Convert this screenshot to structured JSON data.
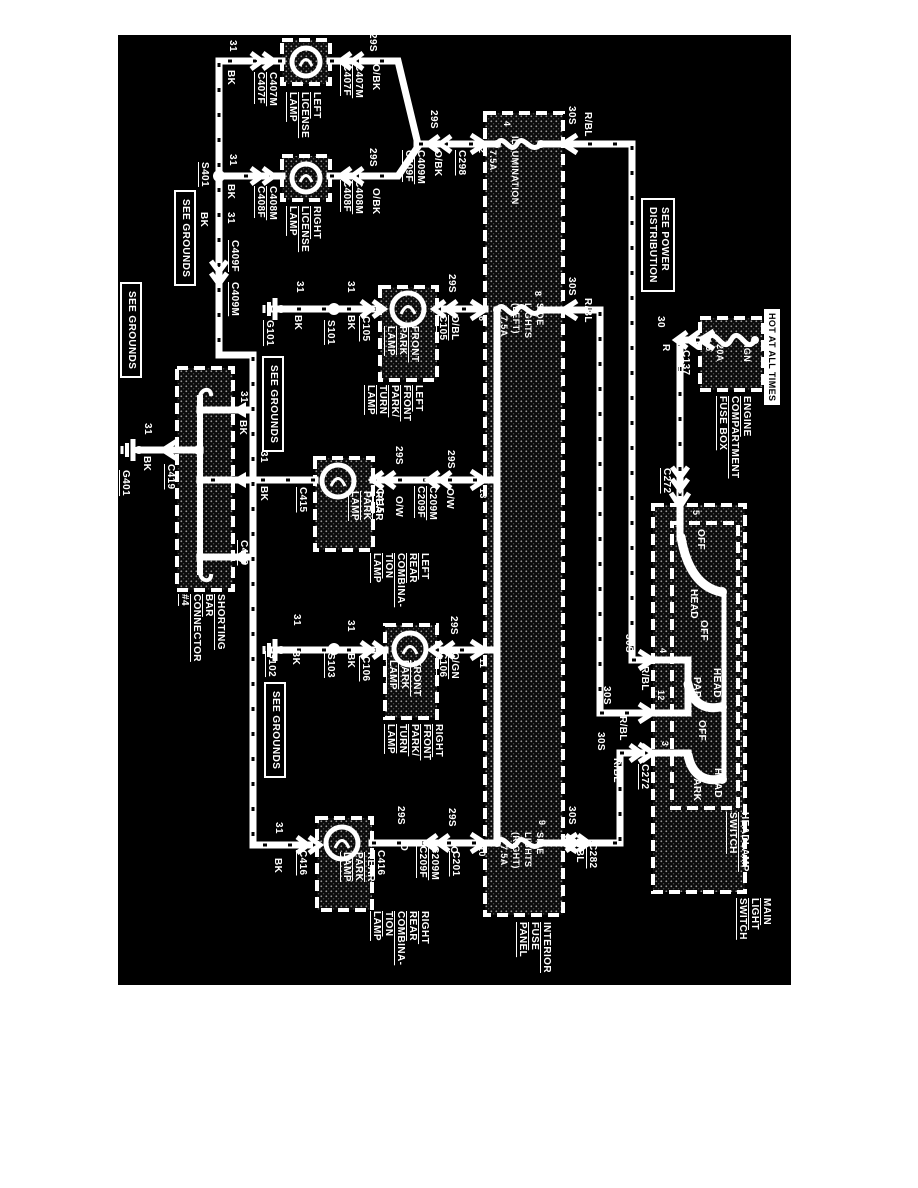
{
  "page": {
    "type": "wiring-diagram",
    "colors": {
      "page_bg": "#ffffff",
      "diagram_bg": "#000000",
      "line": "#ffffff"
    }
  },
  "diagram": {
    "labels": [
      {
        "i": "wire-31-left-license",
        "t": "31",
        "x": 226,
        "y": 40
      },
      {
        "i": "wire-bk-left-license",
        "t": "BK",
        "x": 224,
        "y": 70
      },
      {
        "i": "conn-c407-pair-left",
        "t": "C407M\nC407F",
        "x": 254,
        "y": 72,
        "u": 1
      },
      {
        "i": "left-license-lamp-label",
        "t": "LEFT\nLICENSE\nLAMP",
        "x": 286,
        "y": 92,
        "u": 1
      },
      {
        "i": "conn-c407-pair-right",
        "t": "C407M\nC407F",
        "x": 340,
        "y": 64,
        "u": 1
      },
      {
        "i": "wire-29s-left-license",
        "t": "29S",
        "x": 366,
        "y": 33
      },
      {
        "i": "wire-obk-left-license",
        "t": "O/BK",
        "x": 369,
        "y": 64
      },
      {
        "i": "splice-s401-label",
        "t": "S401",
        "x": 198,
        "y": 162,
        "u": 1
      },
      {
        "i": "wire-31-right-license",
        "t": "31",
        "x": 226,
        "y": 154
      },
      {
        "i": "wire-bk-right-license",
        "t": "BK",
        "x": 224,
        "y": 184
      },
      {
        "i": "conn-c408-pair-left",
        "t": "C408M\nC408F",
        "x": 254,
        "y": 186,
        "u": 1
      },
      {
        "i": "right-license-lamp-label",
        "t": "RIGHT\nLICENSE\nLAMP",
        "x": 286,
        "y": 206,
        "u": 1
      },
      {
        "i": "conn-c408-pair-right",
        "t": "C408M\nC408F",
        "x": 340,
        "y": 180,
        "u": 1
      },
      {
        "i": "wire-29s-right-license",
        "t": "29S",
        "x": 366,
        "y": 148
      },
      {
        "i": "wire-obk-right-license",
        "t": "O/BK",
        "x": 369,
        "y": 188
      },
      {
        "i": "wire-29s-merge",
        "t": "29S",
        "x": 427,
        "y": 110
      },
      {
        "i": "conn-c409-pair-merge",
        "t": "C409M\nC409F",
        "x": 402,
        "y": 150,
        "u": 1
      },
      {
        "i": "wire-obk-merge",
        "t": "O/BK",
        "x": 431,
        "y": 150
      },
      {
        "i": "conn-c298",
        "t": "C298",
        "x": 455,
        "y": 150,
        "u": 1
      },
      {
        "i": "wire-31-bus",
        "t": "31",
        "x": 224,
        "y": 212
      },
      {
        "i": "wire-bk-bus",
        "t": "BK",
        "x": 197,
        "y": 212
      },
      {
        "i": "conn-c409f-bus",
        "t": "C409F",
        "x": 228,
        "y": 240,
        "u": 1
      },
      {
        "i": "conn-c409m-bus",
        "t": "C409M",
        "x": 228,
        "y": 282,
        "u": 1
      },
      {
        "i": "see-grounds-1",
        "t": "SEE GROUNDS",
        "x": 174,
        "y": 190,
        "b": 1
      },
      {
        "i": "see-grounds-2",
        "t": "SEE GROUNDS",
        "x": 262,
        "y": 356,
        "b": 1
      },
      {
        "i": "see-grounds-3",
        "t": "SEE GROUNDS",
        "x": 120,
        "y": 282,
        "b": 1
      },
      {
        "i": "see-grounds-4",
        "t": "SEE GROUNDS",
        "x": 264,
        "y": 682,
        "b": 1
      },
      {
        "i": "wire-31-branch1",
        "t": "31",
        "x": 237,
        "y": 391
      },
      {
        "i": "wire-bk-branch1",
        "t": "BK",
        "x": 236,
        "y": 420
      },
      {
        "i": "wire-31-c415-gnd",
        "t": "31",
        "x": 257,
        "y": 451
      },
      {
        "i": "wire-bk-c415-gnd",
        "t": "BK",
        "x": 257,
        "y": 486
      },
      {
        "i": "conn-c419-entry",
        "t": "C419",
        "x": 237,
        "y": 540,
        "u": 1
      },
      {
        "i": "shorting-bar-label",
        "t": "SHORTING\nBAR\nCONNECTOR\n#4",
        "x": 178,
        "y": 594,
        "u": 1
      },
      {
        "i": "conn-c419-exit",
        "t": "C419",
        "x": 164,
        "y": 464,
        "u": 1
      },
      {
        "i": "wire-31-g401",
        "t": "31",
        "x": 141,
        "y": 423
      },
      {
        "i": "wire-bk-g401",
        "t": "BK",
        "x": 140,
        "y": 456
      },
      {
        "i": "ground-g401-label",
        "t": "G401",
        "x": 119,
        "y": 470,
        "u": 1
      },
      {
        "i": "ground-g101-label",
        "t": "G101",
        "x": 263,
        "y": 320,
        "u": 1
      },
      {
        "i": "wire-31-g101",
        "t": "31",
        "x": 293,
        "y": 281
      },
      {
        "i": "wire-bk-g101",
        "t": "BK",
        "x": 291,
        "y": 315
      },
      {
        "i": "splice-s101-label",
        "t": "S101",
        "x": 324,
        "y": 320,
        "u": 1
      },
      {
        "i": "wire-31-s101",
        "t": "31",
        "x": 344,
        "y": 281
      },
      {
        "i": "wire-bk-s101",
        "t": "BK",
        "x": 344,
        "y": 315
      },
      {
        "i": "conn-c105-left",
        "t": "C105",
        "x": 359,
        "y": 316,
        "u": 1
      },
      {
        "i": "front-park-lamp-1-label",
        "t": "FRONT\nPARK\nLAMP",
        "x": 384,
        "y": 326,
        "u": 1
      },
      {
        "i": "wire-29s-c105",
        "t": "29S",
        "x": 445,
        "y": 274
      },
      {
        "i": "conn-obl-c105",
        "t": "O/BL\nC105",
        "x": 436,
        "y": 315,
        "u": 1
      },
      {
        "i": "left-front-park-turn-label",
        "t": "LEFT\nFRONT\nPARK/\nTURN\nLAMP",
        "x": 364,
        "y": 385,
        "u": 1
      },
      {
        "i": "fp-pin-4",
        "t": "4",
        "x": 501,
        "y": 121,
        "f": 9
      },
      {
        "i": "fp-pin-2",
        "t": "2",
        "x": 476,
        "y": 148,
        "f": 9
      },
      {
        "i": "fuse-illumination",
        "t": "ILLUMINATION",
        "x": 509,
        "y": 136,
        "f": 9
      },
      {
        "i": "fuse-illumination-amp",
        "t": "7.5A",
        "x": 487,
        "y": 150,
        "f": 9
      },
      {
        "i": "fp-pin-8",
        "t": "8",
        "x": 532,
        "y": 291,
        "f": 9
      },
      {
        "i": "fp-pin-6",
        "t": "6",
        "x": 476,
        "y": 316,
        "f": 9
      },
      {
        "i": "fuse-side-lights-left",
        "t": "SIDE\nLIGHTS\n(LEFT)",
        "x": 510,
        "y": 303,
        "f": 9
      },
      {
        "i": "fuse-side-lights-left-amp",
        "t": "7.5A",
        "x": 498,
        "y": 316,
        "f": 9
      },
      {
        "i": "fp-pin-13",
        "t": "13",
        "x": 477,
        "y": 488,
        "f": 9
      },
      {
        "i": "fp-pin-11",
        "t": "11",
        "x": 477,
        "y": 658,
        "f": 9
      },
      {
        "i": "fp-pin-10",
        "t": "10",
        "x": 476,
        "y": 846,
        "f": 9
      },
      {
        "i": "fp-pin-9",
        "t": "9",
        "x": 536,
        "y": 820,
        "f": 9
      },
      {
        "i": "fuse-side-lights-right",
        "t": "SIDE\nLIGHTS\n(RIGHT)",
        "x": 510,
        "y": 832,
        "f": 9
      },
      {
        "i": "fuse-side-lights-right-amp",
        "t": "7.5A",
        "x": 498,
        "y": 845,
        "f": 9
      },
      {
        "i": "interior-fuse-panel-label",
        "t": "INTERIOR\nFUSE\nPANEL",
        "x": 516,
        "y": 922,
        "u": 1
      },
      {
        "i": "wire-30s-pin4",
        "t": "30S",
        "x": 565,
        "y": 106
      },
      {
        "i": "wire-rbl-pin4",
        "t": "R/BL",
        "x": 581,
        "y": 112
      },
      {
        "i": "wire-30s-pin8",
        "t": "30S",
        "x": 565,
        "y": 277
      },
      {
        "i": "wire-rbl-pin8",
        "t": "R/BL",
        "x": 581,
        "y": 298
      },
      {
        "i": "wire-30s-pin9",
        "t": "30S",
        "x": 565,
        "y": 806
      },
      {
        "i": "wire-rbl-pin9",
        "t": "R/BL",
        "x": 573,
        "y": 838
      },
      {
        "i": "conn-c282",
        "t": "C282",
        "x": 586,
        "y": 843,
        "u": 1
      },
      {
        "i": "wire-30s-sw4",
        "t": "30S",
        "x": 622,
        "y": 634
      },
      {
        "i": "wire-rbl-sw4",
        "t": "R/BL",
        "x": 638,
        "y": 666
      },
      {
        "i": "wire-30s-sw12",
        "t": "30S",
        "x": 600,
        "y": 686
      },
      {
        "i": "wire-rbl-sw12",
        "t": "R/BL",
        "x": 616,
        "y": 716
      },
      {
        "i": "wire-30s-sw3",
        "t": "30S",
        "x": 594,
        "y": 732
      },
      {
        "i": "wire-rbl-sw3",
        "t": "R/BL",
        "x": 610,
        "y": 758
      },
      {
        "i": "conn-c272-sw3",
        "t": "C272",
        "x": 638,
        "y": 764,
        "u": 1
      },
      {
        "i": "see-power-distribution",
        "t": "SEE POWER\nDISTRIBUTION",
        "x": 641,
        "y": 198,
        "b": 1
      },
      {
        "i": "fuse-ign",
        "t": "IGN",
        "x": 741,
        "y": 345,
        "f": 9
      },
      {
        "i": "fuse-ign-amp",
        "t": "20A",
        "x": 714,
        "y": 344,
        "f": 9
      },
      {
        "i": "ef-pin-5",
        "t": "5",
        "x": 703,
        "y": 346,
        "f": 9
      },
      {
        "i": "conn-c137",
        "t": "C137",
        "x": 679,
        "y": 350,
        "u": 1
      },
      {
        "i": "wire-30-engine",
        "t": "30",
        "x": 654,
        "y": 316
      },
      {
        "i": "wire-r-engine",
        "t": "R",
        "x": 659,
        "y": 344
      },
      {
        "i": "hot-at-all-times",
        "t": "HOT AT ALL TIMES",
        "x": 764,
        "y": 309,
        "v": 1,
        "f": 9
      },
      {
        "i": "engine-fuse-box-label",
        "t": "ENGINE\nCOMPARTMENT\nFUSE BOX",
        "x": 716,
        "y": 396,
        "u": 1
      },
      {
        "i": "conn-c272-top",
        "t": "C272",
        "x": 660,
        "y": 468,
        "u": 1
      },
      {
        "i": "sw-pin-5",
        "t": "5",
        "x": 690,
        "y": 510,
        "f": 9
      },
      {
        "i": "sw1-off",
        "t": "OFF",
        "x": 694,
        "y": 529
      },
      {
        "i": "sw1-head",
        "t": "HEAD",
        "x": 687,
        "y": 589
      },
      {
        "i": "sw-pin-4",
        "t": "4",
        "x": 657,
        "y": 648,
        "f": 9
      },
      {
        "i": "sw-pin-12",
        "t": "12",
        "x": 655,
        "y": 690,
        "f": 9
      },
      {
        "i": "sw2-off",
        "t": "OFF",
        "x": 697,
        "y": 620
      },
      {
        "i": "sw2-park",
        "t": "PARK",
        "x": 690,
        "y": 677
      },
      {
        "i": "sw2-head",
        "t": "HEAD",
        "x": 710,
        "y": 668
      },
      {
        "i": "sw-pin-3",
        "t": "3",
        "x": 659,
        "y": 741,
        "f": 9
      },
      {
        "i": "sw3-off",
        "t": "OFF",
        "x": 695,
        "y": 720
      },
      {
        "i": "sw3-park",
        "t": "PARK",
        "x": 690,
        "y": 772
      },
      {
        "i": "sw3-head",
        "t": "HEAD",
        "x": 711,
        "y": 768
      },
      {
        "i": "headlamp-switch-label",
        "t": "HEADLAMP\nSWITCH",
        "x": 726,
        "y": 812,
        "u": 1
      },
      {
        "i": "main-light-switch-label",
        "t": "MAIN\nLIGHT\nSWITCH",
        "x": 736,
        "y": 898,
        "u": 1
      },
      {
        "i": "conn-c415-left",
        "t": "C415",
        "x": 296,
        "y": 487,
        "u": 1
      },
      {
        "i": "rear-park-lamp-1-label",
        "t": "REAR\nPARK\nLAMP",
        "x": 348,
        "y": 491,
        "u": 1
      },
      {
        "i": "conn-c415-right",
        "t": "C415",
        "x": 373,
        "y": 488,
        "u": 1
      },
      {
        "i": "wire-29s-c415a",
        "t": "29S",
        "x": 392,
        "y": 446
      },
      {
        "i": "wire-ow-c415a",
        "t": "O/W",
        "x": 392,
        "y": 496
      },
      {
        "i": "conn-c209-pair-1",
        "t": "C209M\nC209F",
        "x": 414,
        "y": 486,
        "u": 1
      },
      {
        "i": "wire-29s-c415b",
        "t": "29S",
        "x": 444,
        "y": 450
      },
      {
        "i": "wire-ow-c415b",
        "t": "O/W",
        "x": 443,
        "y": 488
      },
      {
        "i": "left-rear-comb-label",
        "t": "LEFT\nREAR\nCOMBINA-\nTION\nLAMP",
        "x": 370,
        "y": 553,
        "u": 1
      },
      {
        "i": "ground-g102-label",
        "t": "G102",
        "x": 265,
        "y": 651,
        "u": 1
      },
      {
        "i": "wire-31-g102",
        "t": "31",
        "x": 290,
        "y": 614
      },
      {
        "i": "wire-bk-g102",
        "t": "BK",
        "x": 289,
        "y": 650
      },
      {
        "i": "splice-s103-label",
        "t": "S103",
        "x": 324,
        "y": 653,
        "u": 1
      },
      {
        "i": "wire-31-s103",
        "t": "31",
        "x": 344,
        "y": 620
      },
      {
        "i": "wire-bk-s103",
        "t": "BK",
        "x": 344,
        "y": 653
      },
      {
        "i": "conn-c106-left",
        "t": "C106",
        "x": 359,
        "y": 656,
        "u": 1
      },
      {
        "i": "front-park-lamp-2-label",
        "t": "FRONT\nPARK\nLAMP",
        "x": 386,
        "y": 660,
        "u": 1
      },
      {
        "i": "wire-29s-c106",
        "t": "29S",
        "x": 447,
        "y": 616
      },
      {
        "i": "conn-ogn-c106",
        "t": "O/GN\nC106",
        "x": 436,
        "y": 652,
        "u": 1
      },
      {
        "i": "right-front-park-turn-label",
        "t": "RIGHT\nFRONT\nPARK/\nTURN\nLAMP",
        "x": 384,
        "y": 724,
        "u": 1
      },
      {
        "i": "conn-c416-left",
        "t": "C416",
        "x": 296,
        "y": 850,
        "u": 1
      },
      {
        "i": "wire-31-c416",
        "t": "31",
        "x": 272,
        "y": 822
      },
      {
        "i": "wire-bk-c416",
        "t": "BK",
        "x": 271,
        "y": 858
      },
      {
        "i": "rear-park-lamp-2-label",
        "t": "REAR\nPARK\nLAMP",
        "x": 340,
        "y": 852,
        "u": 1
      },
      {
        "i": "conn-c416-right",
        "t": "C416",
        "x": 374,
        "y": 850,
        "u": 1
      },
      {
        "i": "wire-29s-c416a",
        "t": "29S",
        "x": 394,
        "y": 806
      },
      {
        "i": "wire-o-c416a",
        "t": "O",
        "x": 397,
        "y": 843
      },
      {
        "i": "conn-c209-pair-2",
        "t": "C209M\nC209F",
        "x": 416,
        "y": 846,
        "u": 1
      },
      {
        "i": "wire-29s-c416b",
        "t": "29S",
        "x": 445,
        "y": 808
      },
      {
        "i": "wire-o-c416b",
        "t": "O",
        "x": 447,
        "y": 846
      },
      {
        "i": "conn-c201",
        "t": "C201",
        "x": 449,
        "y": 851,
        "u": 1
      },
      {
        "i": "right-rear-comb-label",
        "t": "RIGHT\nREAR\nCOMBINA-\nTION\nLAMP",
        "x": 370,
        "y": 911,
        "u": 1
      }
    ]
  }
}
